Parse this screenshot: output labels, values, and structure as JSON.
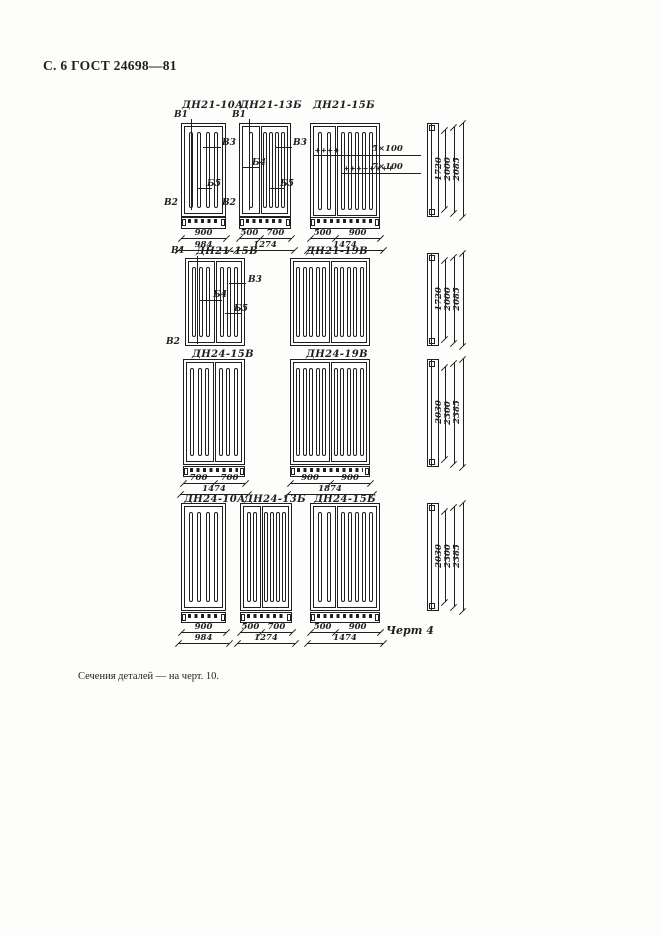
{
  "page": {
    "header": "С. 6 ГОСТ 24698—81",
    "figure_caption": "Черт 4",
    "footnote": "Сечения деталей — на черт. 10."
  },
  "figure": {
    "doors": [
      {
        "id": "dn21-10a",
        "label": "ДН21-10А",
        "marks": [
          "В1",
          "В3",
          "Б5",
          "В2"
        ],
        "leaf_dims": [
          "900"
        ],
        "overall_dim": "984"
      },
      {
        "id": "dn21-13b",
        "label": "ДН21-13Б",
        "marks": [
          "В1",
          "В3",
          "Б4",
          "Б5",
          "В2"
        ],
        "leaf_dims": [
          "500",
          "700"
        ],
        "overall_dim": "1274"
      },
      {
        "id": "dn21-15b",
        "label": "ДН21-15Б",
        "annotations": [
          "5×100",
          "7×100"
        ],
        "leaf_dims": [
          "500",
          "900"
        ],
        "overall_dim": "1474"
      },
      {
        "id": "dn21-15v",
        "label": "ДН21-15В",
        "marks": [
          "В1",
          "В3",
          "Б4",
          "Б5",
          "В2"
        ]
      },
      {
        "id": "dn21-19v",
        "label": "ДН21-19В"
      },
      {
        "id": "dn24-15v",
        "label": "ДН24-15В",
        "leaf_dims": [
          "700",
          "700"
        ],
        "overall_dim": "1474"
      },
      {
        "id": "dn24-19v",
        "label": "ДН24-19В",
        "leaf_dims": [
          "900",
          "900"
        ],
        "overall_dim": "1874"
      },
      {
        "id": "dn24-10a",
        "label": "ДН24-10А",
        "leaf_dims": [
          "900"
        ],
        "overall_dim": "984"
      },
      {
        "id": "dn24-13b",
        "label": "ДН24-13Б",
        "leaf_dims": [
          "500",
          "700"
        ],
        "overall_dim": "1274"
      },
      {
        "id": "dn24-15b",
        "label": "ДН24-15Б",
        "leaf_dims": [
          "500",
          "900"
        ],
        "overall_dim": "1474"
      }
    ],
    "profiles": [
      {
        "heights": [
          "1720",
          "2000",
          "2085"
        ]
      },
      {
        "heights": [
          "1720",
          "2000",
          "2085"
        ]
      },
      {
        "heights": [
          "2030",
          "2300",
          "2385"
        ]
      },
      {
        "heights": [
          "2030",
          "2300",
          "2385"
        ]
      }
    ]
  }
}
